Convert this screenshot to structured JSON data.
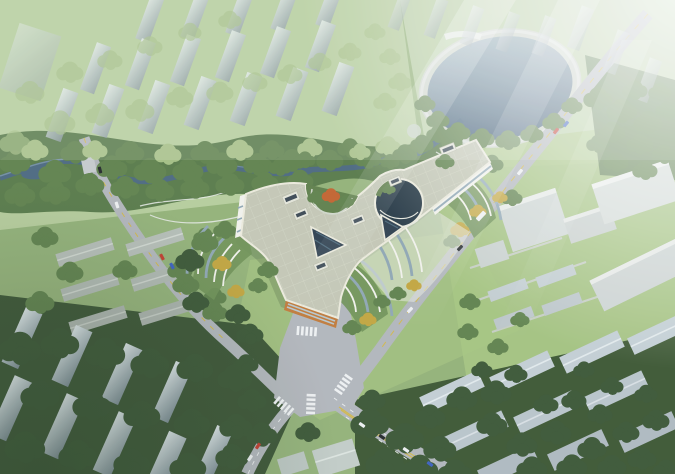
{
  "meta": {
    "title": "Aerial architectural rendering of a Y-shaped hospital campus",
    "image_type": "architectural-render",
    "view": "oblique aerial / bird's-eye",
    "has_text": false
  },
  "palette": {
    "terrain-light": "#bcd2a2",
    "terrain-mid": "#93b178",
    "terrain-dark": "#47633c",
    "lawn": "#a6c481",
    "tree-light": "#a4bf84",
    "tree-mid": "#5f814c",
    "tree-dark": "#3a5635",
    "tree-yellow": "#c2a53f",
    "tree-orange": "#c2622f",
    "water-light": "#93aab6",
    "water-deep": "#3c5873",
    "stream": "#4b6880",
    "road": "#b2b6bc",
    "road-line-white": "#eceef0",
    "road-line-yellow": "#d2b84a",
    "roof-main": "#c4c7b6",
    "roof-grid": "#d9dbca",
    "parapet": "#eceadd",
    "facade-white": "#f2f2ec",
    "glass-dark": "#2f4050",
    "glass-mid": "#8fa6b4",
    "glass-light": "#b7c7ce",
    "accent-orange": "#c07a3a",
    "terrace-green": "#6f9157",
    "slab-face": "#e6edef",
    "slab-shade": "#8c9aa3",
    "car-red": "#c23b2e",
    "car-blue": "#3a5fc0",
    "car-white": "#eef0f2",
    "car-dark": "#23272b",
    "haze": "#ffffff"
  },
  "scene": {
    "main_building": {
      "label": "tri-lobed (Y-shaped) low-rise complex with sage paneled roof",
      "features": [
        "circular roof garden courtyard with one orange tree",
        "deep circular glass atrium courtyard",
        "two triangular glass skylight courts",
        "six rooftop skylight boxes",
        "curved terraced garden wings (west, south, northeast)",
        "orange glazed end facade on south lobe"
      ]
    },
    "water": {
      "lake": "round lake with shoreline promenade, upper right",
      "stream": "winding canal through tree park band across the middle"
    },
    "roads": [
      "northwest diagonal road with yellow dashes",
      "northeast boulevard from top-right corner past campus east side",
      "south entrance avenue and intersection plaza with crosswalks",
      "southeast road with double yellow line",
      "southwest road to bottom edge"
    ],
    "districts": [
      "hazy residential tower rows, top-left",
      "hazy residential towers above lake, top-right",
      "grey row housing, mid-left",
      "dark tree belt with tower slabs, bottom-left",
      "row housing among dense trees, bottom-right",
      "large flat industrial blocks with lawns, right-middle"
    ],
    "vehicles": {
      "count": 16,
      "types": [
        "cars",
        "one bus"
      ]
    },
    "atmosphere": [
      "white fog over both top corners",
      "diagonal sun-haze rays from upper right"
    ]
  }
}
